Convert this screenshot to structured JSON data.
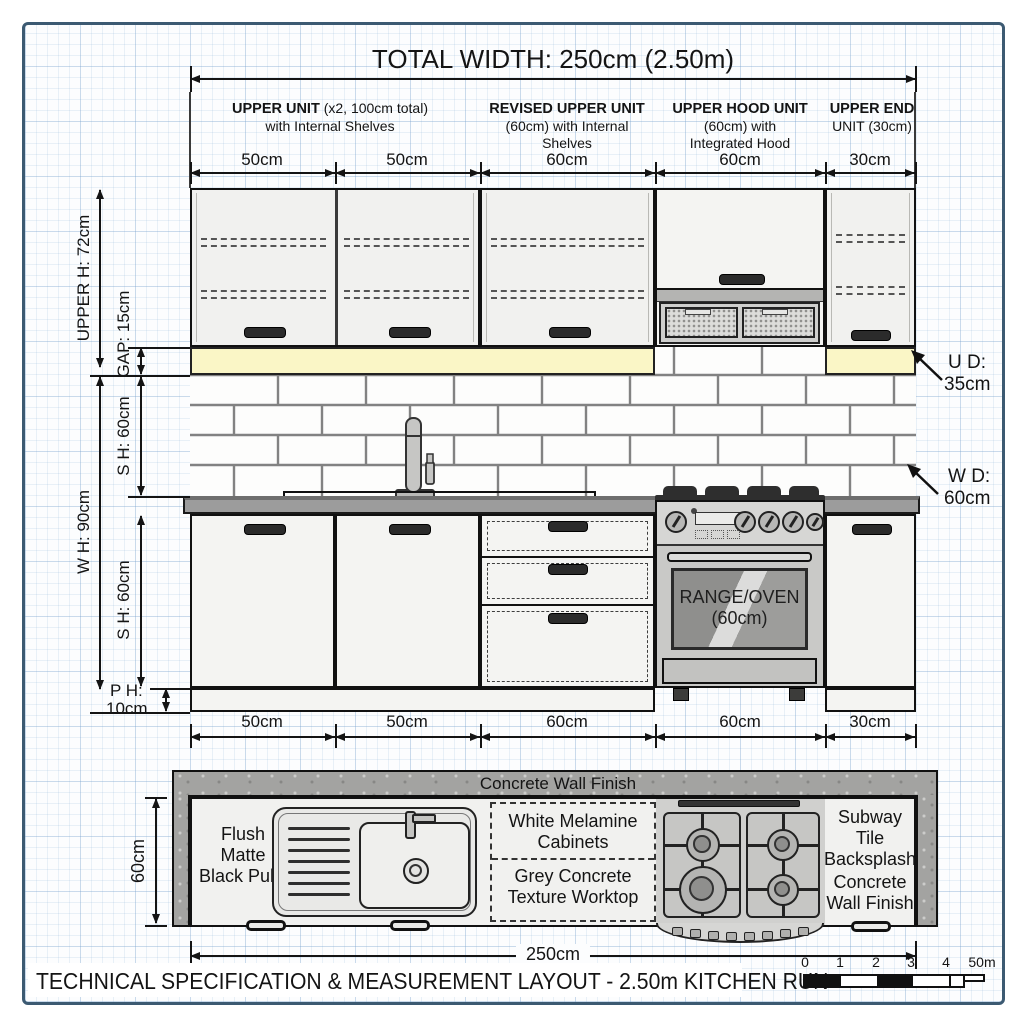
{
  "page": {
    "top_title": "TOTAL WIDTH: 250cm (2.50m)",
    "footer_title": "TECHNICAL SPECIFICATION & MEASUREMENT LAYOUT - 2.50m KITCHEN RUN"
  },
  "upper_units": [
    {
      "heading": "UPPER UNIT",
      "detail": " (x2, 100cm total)",
      "line2": "with Internal Shelves",
      "line3": ""
    },
    {
      "heading": "REVISED UPPER UNIT",
      "detail": "",
      "line2": "(60cm) with Internal",
      "line3": "Shelves"
    },
    {
      "heading": "UPPER HOOD UNIT",
      "detail": "",
      "line2": "(60cm) with",
      "line3": "Integrated Hood"
    },
    {
      "heading": "UPPER END",
      "detail": "",
      "line2": "UNIT (30cm)",
      "line3": ""
    }
  ],
  "dims": {
    "top": [
      "50cm",
      "50cm",
      "60cm",
      "60cm",
      "30cm"
    ],
    "bottom": [
      "50cm",
      "50cm",
      "60cm",
      "60cm",
      "30cm"
    ],
    "upper_height": "UPPER H: 72cm",
    "gap": "GAP: 15cm",
    "splash_height": "S H: 60cm",
    "worktop_height": "W H: 90cm",
    "base_height": "S H: 60cm",
    "plinth_label": "P H:",
    "plinth_value": "10cm",
    "upper_depth_label": "U D:",
    "upper_depth_value": "35cm",
    "worktop_depth_label": "W D:",
    "worktop_depth_value": "60cm",
    "plan_depth": "60cm",
    "plan_width": "250cm"
  },
  "appliances": {
    "range_line1": "RANGE/OVEN",
    "range_line2": "(60cm)"
  },
  "plan": {
    "wall_finish": "Concrete Wall Finish",
    "pulls": [
      "Flush",
      "Matte",
      "Black Pulls"
    ],
    "cabinets": [
      "White Melamine",
      "Cabinets"
    ],
    "worktop": [
      "Grey Concrete",
      "Texture Worktop"
    ],
    "backsplash": [
      "Subway",
      "Tile",
      "Backsplash"
    ],
    "wall": [
      "Concrete",
      "Wall Finish"
    ]
  },
  "scale_bar": {
    "labels": [
      "0",
      "1",
      "2",
      "3",
      "4",
      "50m"
    ]
  },
  "colors": {
    "accent_yellow": "#faf6c6",
    "worktop_grey": "#9c9c9c",
    "wall_grey": "#a3a3a1",
    "frame_blue": "#3c5a72"
  }
}
